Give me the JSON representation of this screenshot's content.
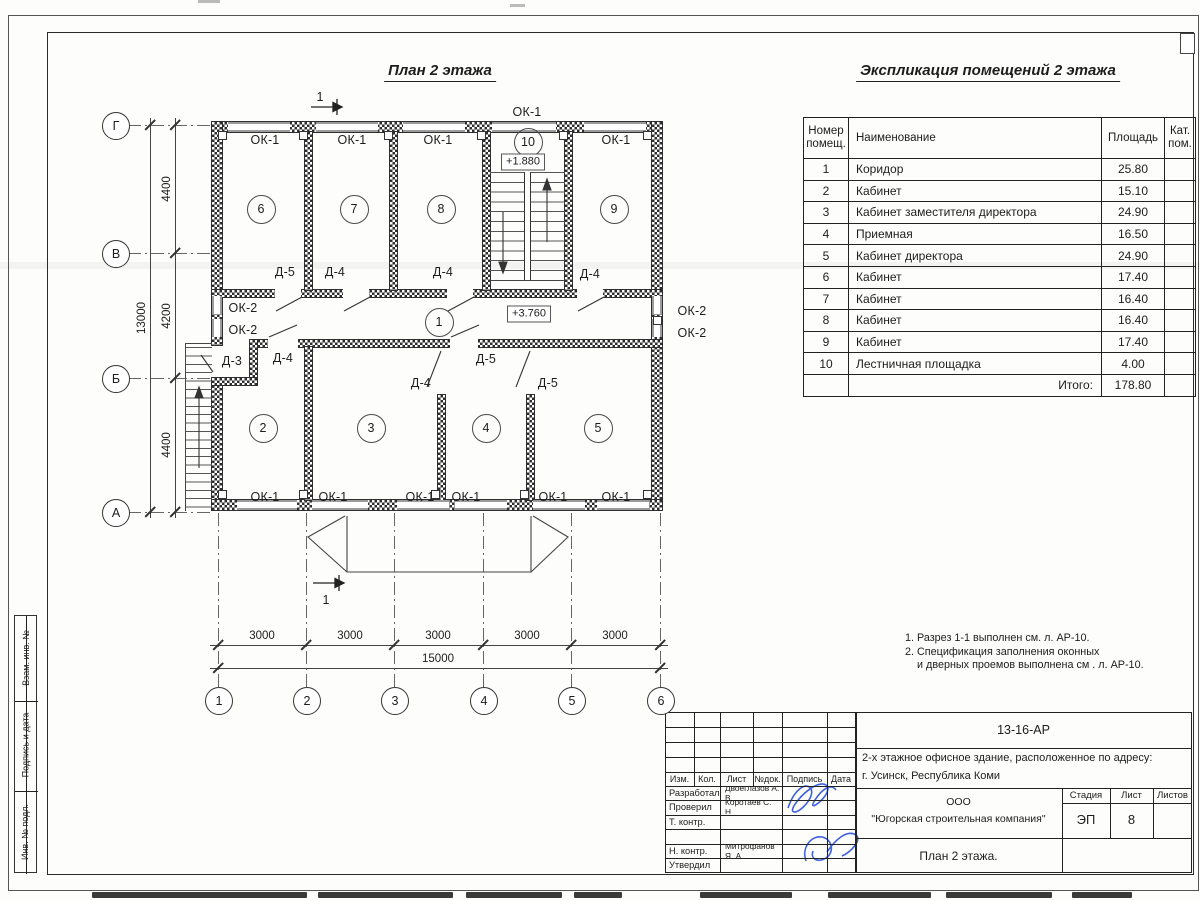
{
  "plan": {
    "title": "План 2 этажа",
    "room_circles": [
      {
        "n": "6",
        "x": 260,
        "y": 208
      },
      {
        "n": "7",
        "x": 353,
        "y": 208
      },
      {
        "n": "8",
        "x": 440,
        "y": 208
      },
      {
        "n": "9",
        "x": 613,
        "y": 208
      },
      {
        "n": "10",
        "x": 527,
        "y": 141
      },
      {
        "n": "1",
        "x": 438,
        "y": 321
      },
      {
        "n": "2",
        "x": 262,
        "y": 427
      },
      {
        "n": "3",
        "x": 370,
        "y": 427
      },
      {
        "n": "4",
        "x": 485,
        "y": 427
      },
      {
        "n": "5",
        "x": 597,
        "y": 427
      }
    ],
    "labels": [
      {
        "t": "ОК-1",
        "x": 265,
        "y": 140
      },
      {
        "t": "ОК-1",
        "x": 352,
        "y": 140
      },
      {
        "t": "ОК-1",
        "x": 438,
        "y": 140
      },
      {
        "t": "ОК-1",
        "x": 616,
        "y": 140
      },
      {
        "t": "ОК-1",
        "x": 527,
        "y": 112
      },
      {
        "t": "Д-5",
        "x": 285,
        "y": 272
      },
      {
        "t": "Д-4",
        "x": 335,
        "y": 272
      },
      {
        "t": "Д-4",
        "x": 443,
        "y": 272
      },
      {
        "t": "Д-4",
        "x": 590,
        "y": 274
      },
      {
        "t": "ОК-2",
        "x": 243,
        "y": 308
      },
      {
        "t": "ОК-2",
        "x": 243,
        "y": 330
      },
      {
        "t": "ОК-2",
        "x": 692,
        "y": 311
      },
      {
        "t": "ОК-2",
        "x": 692,
        "y": 333
      },
      {
        "t": "Д-3",
        "x": 232,
        "y": 361
      },
      {
        "t": "Д-4",
        "x": 283,
        "y": 358
      },
      {
        "t": "Д-5",
        "x": 486,
        "y": 359
      },
      {
        "t": "Д-4",
        "x": 421,
        "y": 383
      },
      {
        "t": "Д-5",
        "x": 548,
        "y": 383
      },
      {
        "t": "ОК-1",
        "x": 265,
        "y": 497
      },
      {
        "t": "ОК-1",
        "x": 333,
        "y": 497
      },
      {
        "t": "ОК-1",
        "x": 420,
        "y": 497
      },
      {
        "t": "ОК-1",
        "x": 466,
        "y": 497
      },
      {
        "t": "ОК-1",
        "x": 553,
        "y": 497
      },
      {
        "t": "ОК-1",
        "x": 616,
        "y": 497
      }
    ],
    "elevations": [
      {
        "t": "+1.880",
        "x": 523,
        "y": 162
      },
      {
        "t": "+3.760",
        "x": 529,
        "y": 314
      }
    ],
    "grid_bottom": {
      "y": 700,
      "items": [
        {
          "n": "1",
          "x": 218
        },
        {
          "n": "2",
          "x": 306
        },
        {
          "n": "3",
          "x": 394
        },
        {
          "n": "4",
          "x": 483
        },
        {
          "n": "5",
          "x": 571
        },
        {
          "n": "6",
          "x": 660
        }
      ]
    },
    "grid_left": {
      "x": 115,
      "items": [
        {
          "n": "Г",
          "y": 125
        },
        {
          "n": "В",
          "y": 253
        },
        {
          "n": "Б",
          "y": 378
        },
        {
          "n": "А",
          "y": 512
        }
      ]
    },
    "dim_labels": [
      {
        "t": "3000",
        "x": 262,
        "y": 636,
        "rot": 0
      },
      {
        "t": "3000",
        "x": 350,
        "y": 636,
        "rot": 0
      },
      {
        "t": "3000",
        "x": 438,
        "y": 636,
        "rot": 0
      },
      {
        "t": "3000",
        "x": 527,
        "y": 636,
        "rot": 0
      },
      {
        "t": "3000",
        "x": 615,
        "y": 636,
        "rot": 0
      },
      {
        "t": "15000",
        "x": 438,
        "y": 659,
        "rot": 0
      },
      {
        "t": "4400",
        "x": 167,
        "y": 189,
        "rot": 1
      },
      {
        "t": "4200",
        "x": 167,
        "y": 316,
        "rot": 1
      },
      {
        "t": "4400",
        "x": 167,
        "y": 445,
        "rot": 1
      },
      {
        "t": "13000",
        "x": 142,
        "y": 318,
        "rot": 1
      }
    ],
    "section_marks": [
      {
        "t": "1",
        "x": 320,
        "y": 97
      },
      {
        "t": "1",
        "x": 326,
        "y": 600
      }
    ]
  },
  "explication": {
    "title": "Экспликация помещений 2 этажа",
    "headers": {
      "num": "Номер\nпомещ.",
      "name": "Наименование",
      "area": "Площадь",
      "cat": "Кат.\nпом."
    },
    "rows": [
      {
        "num": "1",
        "name": "Коридор",
        "area": "25.80"
      },
      {
        "num": "2",
        "name": "Кабинет",
        "area": "15.10"
      },
      {
        "num": "3",
        "name": "Кабинет заместителя директора",
        "area": "24.90"
      },
      {
        "num": "4",
        "name": "Приемная",
        "area": "16.50"
      },
      {
        "num": "5",
        "name": "Кабинет директора",
        "area": "24.90"
      },
      {
        "num": "6",
        "name": "Кабинет",
        "area": "17.40"
      },
      {
        "num": "7",
        "name": "Кабинет",
        "area": "16.40"
      },
      {
        "num": "8",
        "name": "Кабинет",
        "area": "16.40"
      },
      {
        "num": "9",
        "name": "Кабинет",
        "area": "17.40"
      },
      {
        "num": "10",
        "name": "Лестничная площадка",
        "area": "4.00"
      }
    ],
    "total_label": "Итого:",
    "total_value": "178.80"
  },
  "notes": [
    {
      "t": "1. Разрез 1-1 выполнен см. л. АР-10.",
      "indent": 0
    },
    {
      "t": "2. Спецификация заполнения оконных",
      "indent": 0
    },
    {
      "t": "и дверных проемов выполнена см . л. АР-10.",
      "indent": 1
    }
  ],
  "title_block": {
    "doc_number": "13-16-АР",
    "object_line1": "2-х этажное офисное здание, расположенное по адресу:",
    "object_line2": "г. Усинск, Республика Коми",
    "company_line1": "ООО",
    "company_line2": "\"Югорская строительная компания\"",
    "sheet_caption": "План 2 этажа.",
    "stage_label": "Стадия",
    "list_label": "Лист",
    "listov_label": "Листов",
    "stage_value": "ЭП",
    "list_value": "8",
    "listov_value": "",
    "cols": [
      "Изм.",
      "Кол.",
      "Лист",
      "№док.",
      "Подпись",
      "Дата"
    ],
    "roles": [
      {
        "role": "Разработал",
        "name": "Двоеглазов А. В."
      },
      {
        "role": "Проверил",
        "name": "Коротаев С. Н."
      },
      {
        "role": "Т. контр.",
        "name": ""
      },
      {
        "role": "",
        "name": ""
      },
      {
        "role": "Н. контр.",
        "name": "Митрофанов Я. А."
      },
      {
        "role": "Утвердил",
        "name": ""
      }
    ]
  },
  "side_stamp": {
    "cells": [
      "Взам. инв. №",
      "Подпись и дата",
      "Инв. № подл."
    ]
  }
}
